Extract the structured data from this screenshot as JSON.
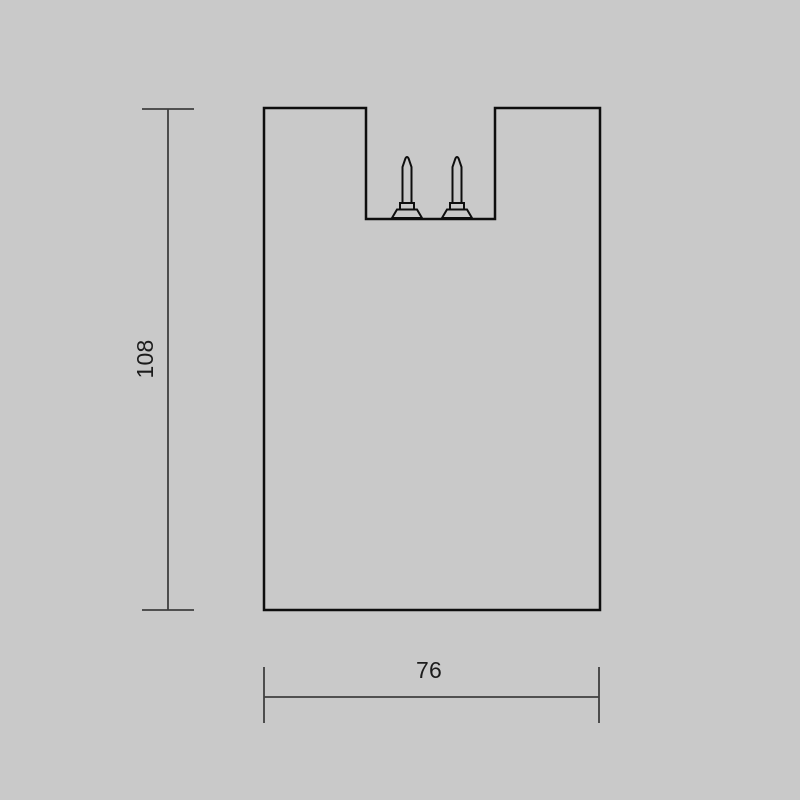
{
  "drawing": {
    "description": "Front-view technical dimension drawing of a fixture body with a recessed top channel and two contact pins",
    "dimensions": {
      "height_label": "108",
      "width_label": "76"
    }
  },
  "colors": {
    "background": "#c9c9c9",
    "outline": "#0e0e0e",
    "dimension_line": "#3f3f3f",
    "label_text": "#1c1c1c"
  }
}
